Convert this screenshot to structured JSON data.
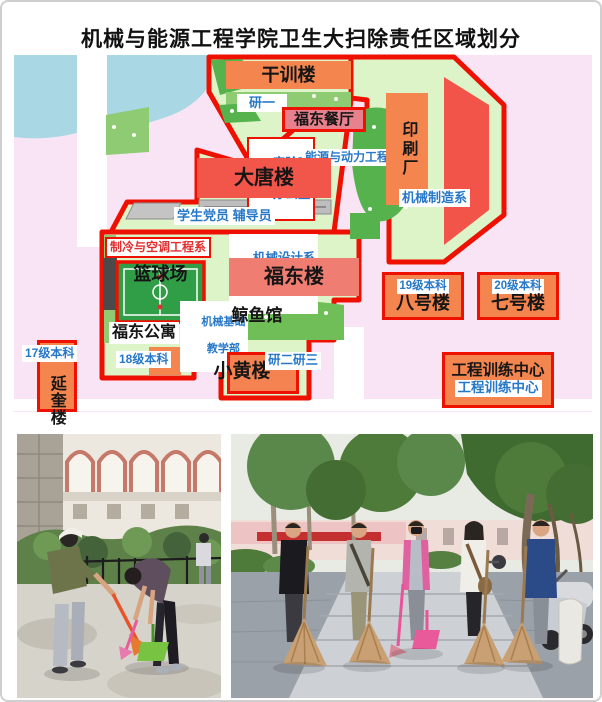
{
  "title": "机械与能源工程学院卫生大扫除责任区域划分",
  "colors": {
    "zone_border": "#ee1101",
    "zone_fill": "#ddf3c8",
    "map_background": "#f9e4f6",
    "pond_blue": "#a9d8e4",
    "building_orange": "#f5854f",
    "building_red": "#f2554a",
    "building_rose": "#e8808d",
    "building_salmon": "#ef7d72",
    "label_blue": "#2878c8",
    "label_red": "#e03030",
    "green_mid": "#56b24c"
  },
  "map": {
    "buildings": {
      "ganxunlou": "干训楼",
      "fudong_canting": "福东餐厅",
      "yinshuachang": "印刷厂",
      "datanglou": "大唐楼",
      "lanqiuchang": "篮球场",
      "fudonglou": "福东楼",
      "jingyuguan": "鲸鱼馆",
      "fudong_gongyu": "福东公寓",
      "xiaohuanglou": "小黄楼",
      "bahaolou": "八号楼",
      "qihaolou": "七号楼",
      "gongcheng_xunlian": "工程训练中心",
      "yankuilou": "延奎楼"
    },
    "labels": {
      "yanyi": "研一",
      "shiyanshi_l1": "实验室",
      "shiyanshi_l2": "办公室",
      "nengyuan": "能源与动力工程系",
      "jixie_zhizao": "机械制造系",
      "dangyuan": "学生党员 辅导员",
      "zhileng": "制冷与空调工程系",
      "jixie_sheji": "机械设计系",
      "jidian_gongcheng": "机电工程系",
      "jixie_jichu_l1": "机械基础",
      "jixie_jichu_l2": "教学部",
      "g18": "18级本科",
      "g17": "17级本科",
      "g19": "19级本科",
      "g20": "20级本科",
      "yaner_yansan": "研二研三",
      "gongxun_blue": "工程训练中心"
    }
  },
  "photos": {
    "left": {
      "alt": "students sweeping a path beside an arched building and hedge"
    },
    "right": {
      "alt": "five people posing with straw brooms under campus trees"
    }
  }
}
